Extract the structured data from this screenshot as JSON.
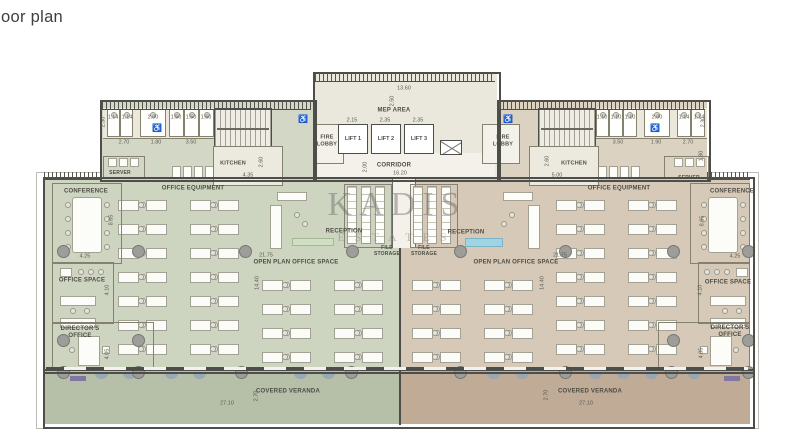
{
  "page": {
    "title_fragment": "oor plan"
  },
  "watermark": {
    "brand": "KADIS",
    "sub": "ESTATES"
  },
  "labels": {
    "mep_area": "MEP AREA",
    "corridor": "CORRIDOR",
    "fire_lobby": "FIRE LOBBY",
    "lift_1": "LIFT 1",
    "lift_2": "LIFT 2",
    "lift_3": "LIFT 3",
    "kitchen": "KITCHEN",
    "server": "SERVER",
    "office_equipment": "OFFICE EQUIPMENT",
    "reception": "RECEPTION",
    "file_storage": "FILE STORAGE",
    "open_plan": "OPEN PLAN OFFICE SPACE",
    "covered_veranda": "COVERED VERANDA",
    "conference": "CONFERENCE",
    "office_space": "OFFICE SPACE",
    "directors_office": "DIRECTOR'S OFFICE"
  },
  "colors": {
    "left_zone": "#cdd4c0",
    "right_zone": "#d6c9b8",
    "veranda_left": "#b6bfa8",
    "veranda_right": "#bfab96",
    "wing_left": "#d3d8c6",
    "wing_right": "#dcd2c2",
    "core": "#eae7dc",
    "corridor": "#f3f1ea",
    "stall_band": "#ebe7da",
    "water": "#9fd4e4",
    "planter": "#cfe0c2",
    "wall": "#4d4d4a"
  },
  "dimensions": [
    {
      "t": "13.60",
      "x": 404,
      "y": 89
    },
    {
      "t": "2.50",
      "x": 393,
      "y": 101,
      "v": 1
    },
    {
      "t": "2.15",
      "x": 352,
      "y": 121
    },
    {
      "t": "2.35",
      "x": 385,
      "y": 121
    },
    {
      "t": "2.35",
      "x": 418,
      "y": 121
    },
    {
      "t": "2.00",
      "x": 366,
      "y": 167,
      "v": 1
    },
    {
      "t": "16.20",
      "x": 400,
      "y": 174
    },
    {
      "t": "1.14",
      "x": 113,
      "y": 118
    },
    {
      "t": "1.14",
      "x": 127,
      "y": 118
    },
    {
      "t": "2.00",
      "x": 153,
      "y": 118
    },
    {
      "t": "1.50",
      "x": 176,
      "y": 118
    },
    {
      "t": "1.50",
      "x": 191,
      "y": 118
    },
    {
      "t": "1.50",
      "x": 206,
      "y": 118
    },
    {
      "t": "2.30",
      "x": 104,
      "y": 122,
      "v": 1
    },
    {
      "t": "2.70",
      "x": 124,
      "y": 143
    },
    {
      "t": "1.80",
      "x": 156,
      "y": 143
    },
    {
      "t": "3.50",
      "x": 191,
      "y": 143
    },
    {
      "t": "2.60",
      "x": 262,
      "y": 162,
      "v": 1
    },
    {
      "t": "4.35",
      "x": 248,
      "y": 176
    },
    {
      "t": "1.10",
      "x": 602,
      "y": 118
    },
    {
      "t": "1.10",
      "x": 616,
      "y": 118
    },
    {
      "t": "1.10",
      "x": 630,
      "y": 118
    },
    {
      "t": "2.00",
      "x": 657,
      "y": 118
    },
    {
      "t": "1.14",
      "x": 684,
      "y": 118
    },
    {
      "t": "1.14",
      "x": 699,
      "y": 118
    },
    {
      "t": "2.30",
      "x": 704,
      "y": 122,
      "v": 1
    },
    {
      "t": "3.50",
      "x": 618,
      "y": 143
    },
    {
      "t": "1.90",
      "x": 656,
      "y": 143
    },
    {
      "t": "2.70",
      "x": 688,
      "y": 143
    },
    {
      "t": "1.80",
      "x": 702,
      "y": 156,
      "v": 1
    },
    {
      "t": "2.60",
      "x": 548,
      "y": 161,
      "v": 1
    },
    {
      "t": "5.00",
      "x": 557,
      "y": 176
    },
    {
      "t": "4.25",
      "x": 85,
      "y": 257
    },
    {
      "t": "8.65",
      "x": 112,
      "y": 220,
      "v": 1
    },
    {
      "t": "4.10",
      "x": 108,
      "y": 290,
      "v": 1
    },
    {
      "t": "4.05",
      "x": 108,
      "y": 354,
      "v": 1
    },
    {
      "t": "4.25",
      "x": 735,
      "y": 257
    },
    {
      "t": "8.65",
      "x": 703,
      "y": 221,
      "v": 1
    },
    {
      "t": "4.10",
      "x": 701,
      "y": 290,
      "v": 1
    },
    {
      "t": "4.05",
      "x": 702,
      "y": 353,
      "v": 1
    },
    {
      "t": "21.75",
      "x": 266,
      "y": 256
    },
    {
      "t": "14.40",
      "x": 258,
      "y": 283,
      "v": 1
    },
    {
      "t": "21.75",
      "x": 560,
      "y": 256
    },
    {
      "t": "14.40",
      "x": 543,
      "y": 283,
      "v": 1
    },
    {
      "t": "27.10",
      "x": 227,
      "y": 404
    },
    {
      "t": "2.70",
      "x": 257,
      "y": 396,
      "v": 1
    },
    {
      "t": "27.10",
      "x": 586,
      "y": 404
    },
    {
      "t": "2.70",
      "x": 547,
      "y": 395,
      "v": 1
    }
  ]
}
